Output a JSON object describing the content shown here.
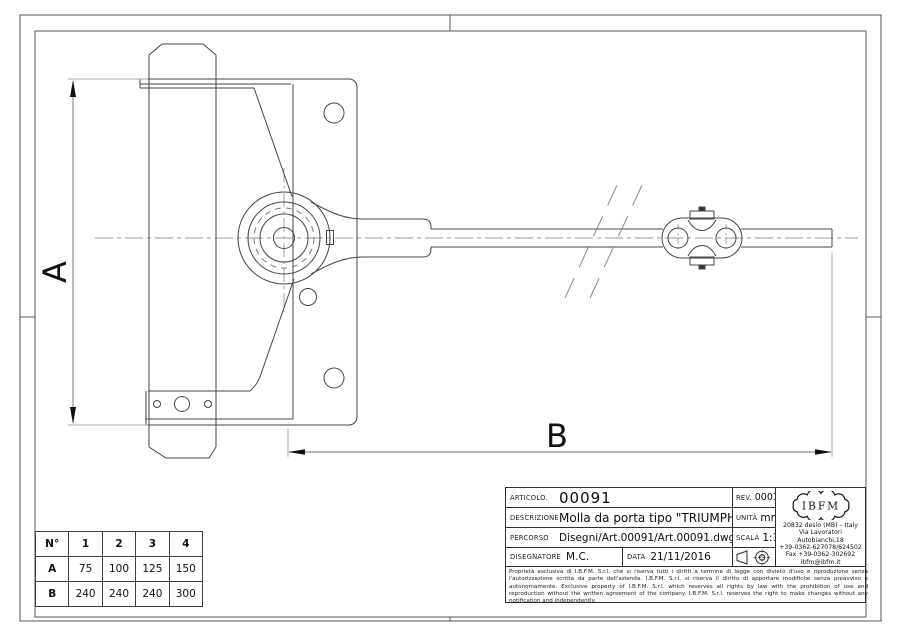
{
  "dimensions": {
    "a_label": "A",
    "b_label": "B"
  },
  "size_table": {
    "header": [
      "N°",
      "1",
      "2",
      "3",
      "4"
    ],
    "row_a": [
      "A",
      "75",
      "100",
      "125",
      "150"
    ],
    "row_b": [
      "B",
      "240",
      "240",
      "240",
      "300"
    ]
  },
  "title_block": {
    "articolo_label": "ARTICOLO.",
    "articolo": "00091",
    "rev_label": "REV.",
    "rev": "0001",
    "descrizione_label": "DESCRIZIONE",
    "descrizione": "Molla da porta tipo \"TRIUMPH\"",
    "unita_label": "UNITÀ",
    "unita": "mm",
    "percorso_label": "PERCORSO",
    "percorso": "Disegni/Art.00091/Art.00091.dwg",
    "scala_label": "SCALA",
    "scala": "1:1",
    "disegnatore_label": "DISEGNATORE",
    "disegnatore": "M.C.",
    "data_label": "DATA",
    "data": "21/11/2016",
    "disclaimer_it": "Proprietà esclusiva di I.B.F.M. S.r.l. che si riserva tutti i diritti a termine di legge con divieto d'uso e riproduzione senza l'autorizzazione scritta da parte dell'azienda. I.B.F.M. S.r.l. si riserva il diritto di apportare modifiche senza preavviso e autonomamente.",
    "disclaimer_en": "Exclusive property of I.B.F.M. S.r.l. which reserves all rights by law with the prohibition of use and reproduction without the written agreement of the company. I.B.F.M. S.r.l. reserves the right to make changes without any notification and independently."
  },
  "company": {
    "logo": "IBFM",
    "address_line1": "20832 desio (MB) – Italy",
    "address_line2": "Via Lavoratori Autobianchi,18",
    "address_line3": "+39-0362-627078/624502",
    "address_line4": "Fax +39-0362-302692",
    "address_line5": "ibfm@ibfm.it"
  },
  "colors": {
    "line": "#454545",
    "frame": "#555555",
    "centerline": "#999999",
    "text": "#111111"
  }
}
